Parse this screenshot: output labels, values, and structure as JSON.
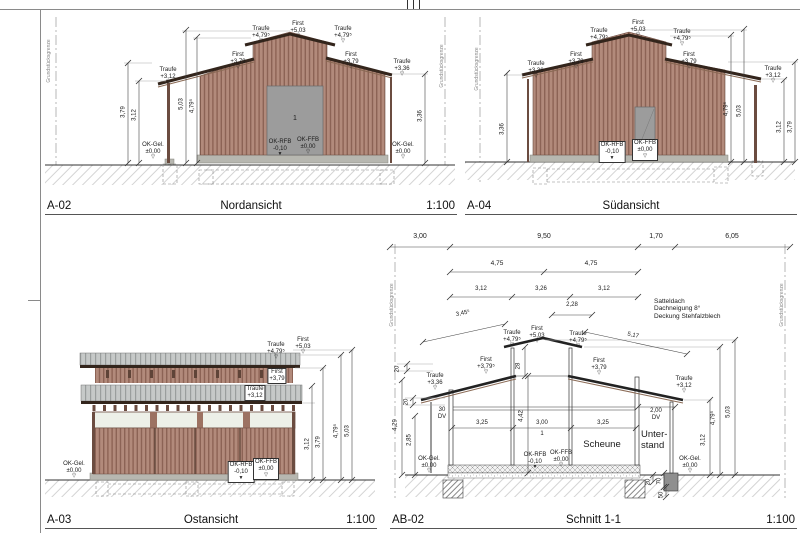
{
  "colors": {
    "wood": "#b28a7b",
    "wood_dark": "#8c6355",
    "roof_dark": "#33251c",
    "metal_roof": "#c6c9c8",
    "plinth": "#b7b7b0",
    "door": "#9c9c9c",
    "dim_line": "#444444",
    "property_line": "#999999"
  },
  "panels": [
    {
      "id": "A-02",
      "title": "Nordansicht",
      "scale": "1:100",
      "labels": [
        {
          "t": "Grundstücksgrenze",
          "x": 10,
          "y": 52,
          "r": -90,
          "s": 5,
          "c": "#888",
          "n": "property-line-label"
        },
        {
          "t": "Grundstücksgrenze",
          "x": 403,
          "y": 57,
          "r": -90,
          "s": 5,
          "c": "#888",
          "n": "property-line-label"
        },
        {
          "t": "Traufe\n+3,12",
          "x": 128,
          "y": 58,
          "m": "o",
          "n": "level-label"
        },
        {
          "t": "First\n+3,79",
          "x": 198,
          "y": 43,
          "m": "o",
          "n": "level-label"
        },
        {
          "t": "Traufe\n+4,79⁵",
          "x": 221,
          "y": 17,
          "m": "o",
          "n": "level-label"
        },
        {
          "t": "First\n+5,03",
          "x": 258,
          "y": 12,
          "m": "o",
          "n": "level-label"
        },
        {
          "t": "Traufe\n+4,79⁵",
          "x": 303,
          "y": 17,
          "m": "o",
          "n": "level-label"
        },
        {
          "t": "First\n+3,79",
          "x": 311,
          "y": 43,
          "m": "o",
          "n": "level-label"
        },
        {
          "t": "Traufe\n+3,36",
          "x": 362,
          "y": 50,
          "m": "o",
          "n": "level-label"
        },
        {
          "t": "3,79",
          "x": 84,
          "y": 103,
          "r": -90
        },
        {
          "t": "3,12",
          "x": 95,
          "y": 106,
          "r": -90
        },
        {
          "t": "5,03",
          "x": 142,
          "y": 95,
          "r": -90
        },
        {
          "t": "4,79⁵",
          "x": 153,
          "y": 97,
          "r": -90
        },
        {
          "t": "3,36",
          "x": 381,
          "y": 107,
          "r": -90
        },
        {
          "t": "OK-Gel.\n±0,00",
          "x": 113,
          "y": 133,
          "m": "o",
          "n": "level-label"
        },
        {
          "t": "OK-RFB\n-0,10",
          "x": 240,
          "y": 130,
          "m": "f",
          "n": "level-label"
        },
        {
          "t": "OK-FFB\n±0,00",
          "x": 268,
          "y": 128,
          "m": "o",
          "n": "level-label"
        },
        {
          "t": "OK-Gel.\n±0,00",
          "x": 363,
          "y": 133,
          "m": "o",
          "n": "level-label"
        },
        {
          "t": "1",
          "x": 255,
          "y": 106,
          "s": 7,
          "n": "door-number"
        }
      ]
    },
    {
      "id": "A-04",
      "title": "Südansicht",
      "scale": "",
      "labels": [
        {
          "t": "Grundstücksgrenze",
          "x": 18,
          "y": 60,
          "r": -90,
          "s": 5,
          "c": "#888",
          "n": "property-line-label"
        },
        {
          "t": "Traufe\n+3,36",
          "x": 76,
          "y": 52,
          "m": "o",
          "n": "level-label"
        },
        {
          "t": "First\n+3,79",
          "x": 116,
          "y": 43,
          "m": "o",
          "n": "level-label"
        },
        {
          "t": "Traufe\n+4,79⁵",
          "x": 139,
          "y": 19,
          "m": "o",
          "n": "level-label"
        },
        {
          "t": "First\n+5,03",
          "x": 178,
          "y": 11,
          "m": "o",
          "n": "level-label"
        },
        {
          "t": "Traufe\n+4,79⁵",
          "x": 222,
          "y": 20,
          "m": "o",
          "n": "level-label"
        },
        {
          "t": "First\n+3,79",
          "x": 229,
          "y": 43,
          "m": "o",
          "n": "level-label"
        },
        {
          "t": "Traufe\n+3,12",
          "x": 313,
          "y": 57,
          "m": "o",
          "n": "level-label"
        },
        {
          "t": "3,36",
          "x": 43,
          "y": 120,
          "r": -90
        },
        {
          "t": "4,79⁵",
          "x": 267,
          "y": 100,
          "r": -90
        },
        {
          "t": "5,03",
          "x": 280,
          "y": 102,
          "r": -90
        },
        {
          "t": "3,12",
          "x": 320,
          "y": 118,
          "r": -90
        },
        {
          "t": "3,79",
          "x": 331,
          "y": 118,
          "r": -90
        },
        {
          "t": "OK-RFB\n-0,10",
          "x": 152,
          "y": 132,
          "b": 1,
          "m": "f",
          "n": "level-label"
        },
        {
          "t": "OK-FFB\n±0,00",
          "x": 185,
          "y": 130,
          "b": 1,
          "m": "o",
          "n": "level-label"
        }
      ]
    },
    {
      "id": "A-03",
      "title": "Ostansicht",
      "scale": "1:100",
      "labels": [
        {
          "t": "Traufe\n+4,79⁵",
          "x": 236,
          "y": 12,
          "m": "o",
          "n": "level-label"
        },
        {
          "t": "First\n+5,03",
          "x": 263,
          "y": 7,
          "m": "o",
          "n": "level-label"
        },
        {
          "t": "First\n+3,79",
          "x": 237,
          "y": 38,
          "b": 1,
          "n": "level-label"
        },
        {
          "t": "Traufe\n+3,12",
          "x": 215,
          "y": 55,
          "b": 1,
          "n": "level-label"
        },
        {
          "t": "OK-Gel.\n±0,00",
          "x": 34,
          "y": 131,
          "m": "o",
          "n": "level-label"
        },
        {
          "t": "OK-RFB\n-0,10",
          "x": 201,
          "y": 131,
          "b": 1,
          "m": "f",
          "n": "level-label"
        },
        {
          "t": "OK-FFB\n±0,00",
          "x": 226,
          "y": 128,
          "b": 1,
          "m": "o",
          "n": "level-label"
        },
        {
          "t": "3,12",
          "x": 268,
          "y": 114,
          "r": -90
        },
        {
          "t": "3,79",
          "x": 279,
          "y": 112,
          "r": -90
        },
        {
          "t": "4,79⁵",
          "x": 297,
          "y": 101,
          "r": -90
        },
        {
          "t": "5,03",
          "x": 308,
          "y": 101,
          "r": -90
        }
      ]
    },
    {
      "id": "AB-02",
      "title": "Schnitt 1-1",
      "scale": "1:100",
      "labels": [
        {
          "t": "Grundstücksgrenze",
          "x": 8,
          "y": 75,
          "r": -90,
          "s": 5,
          "c": "#888",
          "n": "property-line-label"
        },
        {
          "t": "Grundstücksgrenze",
          "x": 398,
          "y": 75,
          "r": -90,
          "s": 5,
          "c": "#888",
          "n": "property-line-label"
        },
        {
          "t": "3,00",
          "x": 35,
          "y": 3,
          "s": 7
        },
        {
          "t": "9,50",
          "x": 159,
          "y": 3,
          "s": 7
        },
        {
          "t": "1,70",
          "x": 271,
          "y": 3,
          "s": 7
        },
        {
          "t": "6,05",
          "x": 347,
          "y": 3,
          "s": 7
        },
        {
          "t": "4,75",
          "x": 112,
          "y": 30,
          "s": 6.5
        },
        {
          "t": "4,75",
          "x": 206,
          "y": 30,
          "s": 6.5
        },
        {
          "t": "3,12",
          "x": 96,
          "y": 56
        },
        {
          "t": "3,26",
          "x": 156,
          "y": 56
        },
        {
          "t": "3,12",
          "x": 219,
          "y": 56
        },
        {
          "t": "2,28",
          "x": 187,
          "y": 72
        },
        {
          "t": "3,45⁵",
          "x": 78,
          "y": 84,
          "r": -12
        },
        {
          "t": "5,17",
          "x": 248,
          "y": 106,
          "r": 12
        },
        {
          "t": "Satteldach\nDachneigung 8°\nDeckung Stehfalzblech",
          "x": 269,
          "y": 68,
          "s": 6.5,
          "a": "l",
          "n": "roof-note"
        },
        {
          "t": "Traufe\n+4,79⁵",
          "x": 127,
          "y": 100,
          "m": "o",
          "n": "level-label"
        },
        {
          "t": "First\n+5,03",
          "x": 152,
          "y": 96,
          "m": "o",
          "n": "level-label"
        },
        {
          "t": "Traufe\n+4,79⁵",
          "x": 193,
          "y": 101,
          "m": "o",
          "n": "level-label"
        },
        {
          "t": "First\n+3,79⁵",
          "x": 101,
          "y": 127,
          "m": "o",
          "n": "level-label"
        },
        {
          "t": "First\n+3,79",
          "x": 214,
          "y": 128,
          "m": "o",
          "n": "level-label"
        },
        {
          "t": "Traufe\n+3,36",
          "x": 50,
          "y": 143,
          "m": "o",
          "n": "level-label"
        },
        {
          "t": "Traufe\n+3,12",
          "x": 299,
          "y": 146,
          "m": "o",
          "n": "level-label"
        },
        {
          "t": "28",
          "x": 134,
          "y": 136,
          "r": -90
        },
        {
          "t": "20",
          "x": 13,
          "y": 139,
          "r": -90
        },
        {
          "t": "20",
          "x": 22,
          "y": 172,
          "r": -90
        },
        {
          "t": "30\nDV",
          "x": 57,
          "y": 177,
          "n": "downpipe-label"
        },
        {
          "t": "4,29",
          "x": 11,
          "y": 195,
          "r": -90
        },
        {
          "t": "2,85",
          "x": 25,
          "y": 210,
          "r": -90
        },
        {
          "t": "3,25",
          "x": 97,
          "y": 190
        },
        {
          "t": "4,42",
          "x": 137,
          "y": 186,
          "r": -90
        },
        {
          "t": "3,00",
          "x": 157,
          "y": 190
        },
        {
          "t": "1",
          "x": 157,
          "y": 201,
          "s": 6,
          "n": "door-number"
        },
        {
          "t": "3,25",
          "x": 218,
          "y": 190
        },
        {
          "t": "Scheune",
          "x": 217,
          "y": 210,
          "s": 9.5,
          "n": "room-label-scheune"
        },
        {
          "t": "Unter-\nstand",
          "x": 256,
          "y": 200,
          "s": 9.5,
          "a": "l",
          "n": "room-label-unterstand"
        },
        {
          "t": "2,00\nDV",
          "x": 271,
          "y": 178,
          "n": "downpipe-label"
        },
        {
          "t": "OK-Gel.\n±0,00",
          "x": 44,
          "y": 226,
          "m": "o",
          "n": "level-label"
        },
        {
          "t": "OK-RFB\n-0,10",
          "x": 150,
          "y": 222,
          "m": "f",
          "n": "level-label"
        },
        {
          "t": "OK-FFB\n±0,00",
          "x": 176,
          "y": 220,
          "m": "o",
          "n": "level-label"
        },
        {
          "t": "OK-Gel.\n±0,00",
          "x": 305,
          "y": 226,
          "m": "o",
          "n": "level-label"
        },
        {
          "t": "3,12",
          "x": 319,
          "y": 210,
          "r": -90
        },
        {
          "t": "4,79⁵",
          "x": 329,
          "y": 188,
          "r": -90
        },
        {
          "t": "5,03",
          "x": 344,
          "y": 182,
          "r": -90
        },
        {
          "t": "20",
          "x": 264,
          "y": 252,
          "r": -90
        },
        {
          "t": "70",
          "x": 275,
          "y": 251,
          "r": -90
        },
        {
          "t": "50",
          "x": 277,
          "y": 265,
          "r": -90
        }
      ]
    }
  ]
}
